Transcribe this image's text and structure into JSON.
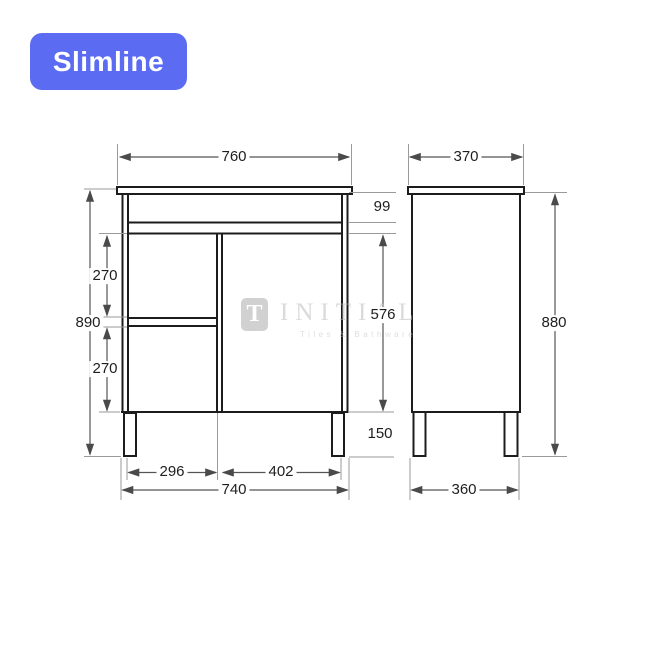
{
  "badge": {
    "label": "Slimline",
    "background_color": "#5B6CF2",
    "text_color": "#FFFFFF"
  },
  "watermark": {
    "logo_letter": "T",
    "brand": "INITIAL",
    "tagline": "Tiles & Bathware"
  },
  "drawing": {
    "object_line_color": "#1C1C1C",
    "dimension_line_color": "#555555",
    "extension_line_color": "#9A9A9A",
    "front_view": {
      "dims": {
        "overall_width": "760",
        "overall_height": "890",
        "top_rail_height": "99",
        "upper_drawer_height": "270",
        "lower_drawer_height": "270",
        "door_height": "576",
        "leg_height": "150",
        "drawer_bank_width": "296",
        "door_width": "402",
        "carcass_width": "740"
      }
    },
    "side_view": {
      "dims": {
        "overall_depth": "370",
        "cabinet_height": "880",
        "base_depth": "360"
      }
    }
  }
}
